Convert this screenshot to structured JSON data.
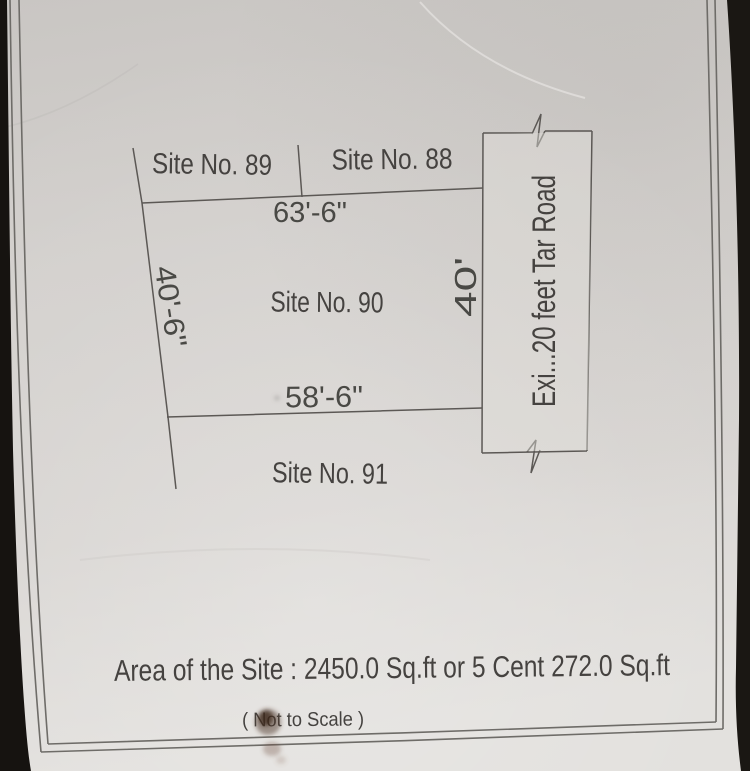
{
  "plan": {
    "sites": {
      "site89": "Site No. 89",
      "site88": "Site No. 88",
      "site90": "Site No. 90",
      "site91": "Site No. 91"
    },
    "dimensions": {
      "top_width": "63'-6\"",
      "bottom_width": "58'-6\"",
      "left_side": "40'-6\"",
      "right_side": "40'"
    },
    "road_label": "Exi...20 feet Tar Road",
    "footer": {
      "area_line": "Area of the Site : 2450.0 Sq.ft or 5 Cent 272.0 Sq.ft",
      "scale_note": "( Not to Scale )"
    },
    "colors": {
      "paper": "#d5d2cf",
      "ink": "#45433f",
      "drawing_line": "#5b5955",
      "photo_background": "#1a1713",
      "smudge": "#4e3527"
    }
  }
}
